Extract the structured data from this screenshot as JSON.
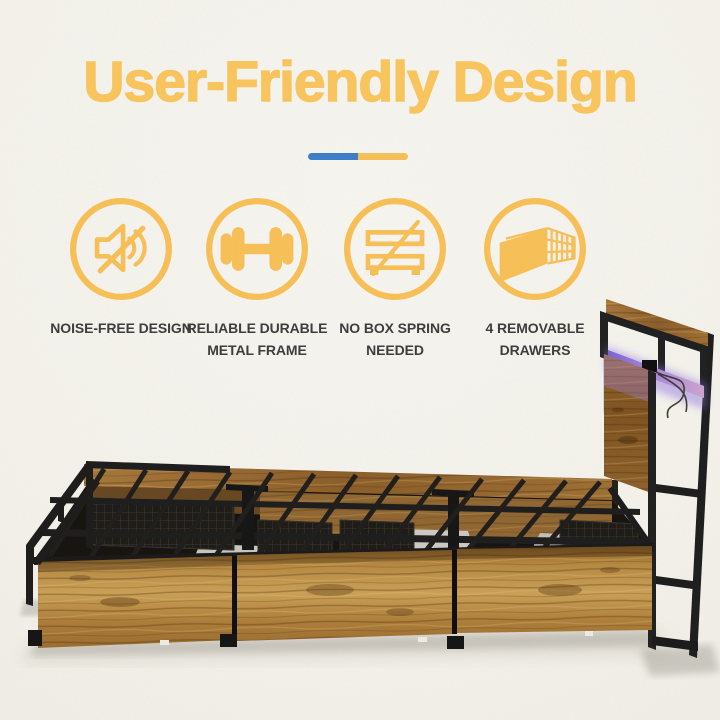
{
  "title": "User-Friendly Design",
  "title_color": "#F8C35C",
  "divider": {
    "left_color": "#3E7CC7",
    "right_color": "#F5BE55"
  },
  "features": [
    {
      "icon": "muted-speaker-icon",
      "line1": "NOISE-FREE DESIGN",
      "line2": ""
    },
    {
      "icon": "dumbbell-icon",
      "line1": "RELIABLE DURABLE",
      "line2": "METAL FRAME"
    },
    {
      "icon": "no-box-spring-icon",
      "line1": "NO BOX SPRING",
      "line2": "NEEDED"
    },
    {
      "icon": "removable-drawer-icon",
      "line1": "4 REMOVABLE",
      "line2": "DRAWERS"
    }
  ],
  "photo_colors": {
    "wood": "#A8742F",
    "metal_frame": "#1F1D1A",
    "led_strip": "#9B7BD0",
    "background_paper": "#F4F2EC",
    "icon_yellow": "#F6BE55"
  }
}
